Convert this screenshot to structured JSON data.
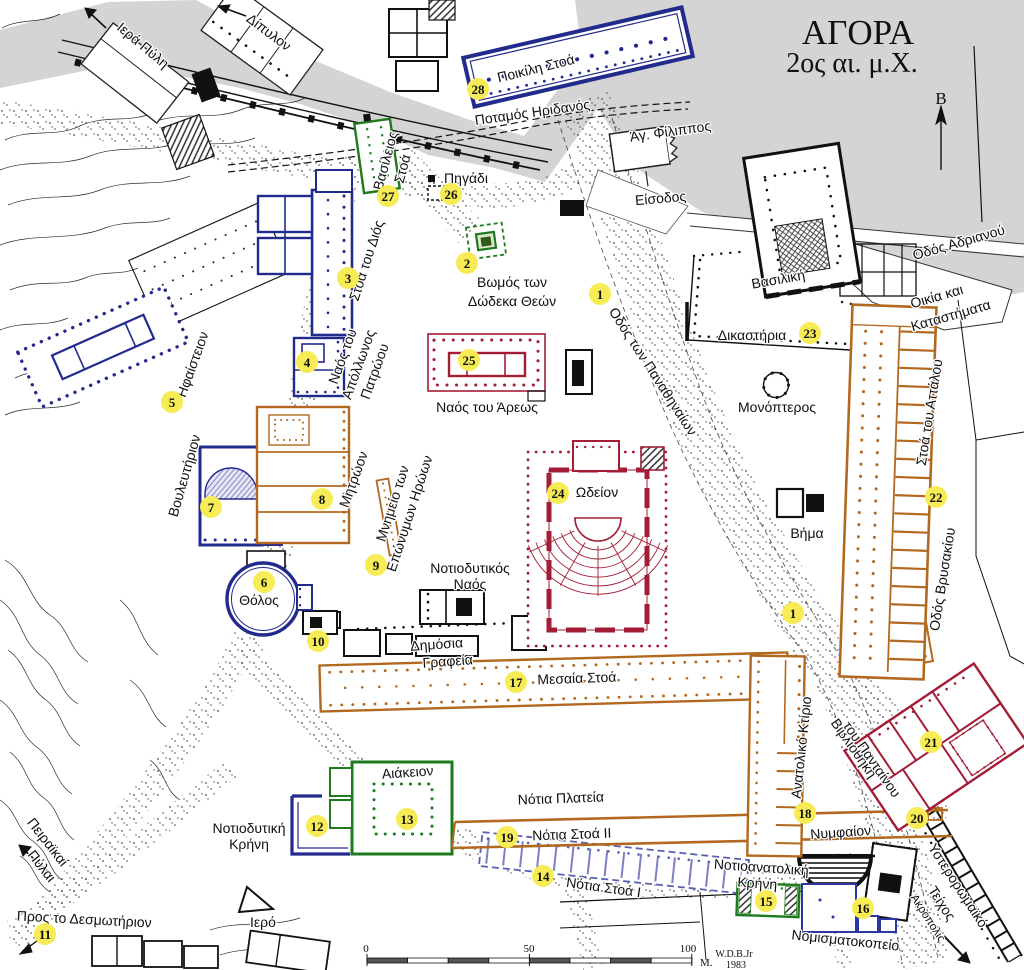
{
  "title": {
    "line1": "ΑΓΟΡΑ",
    "line2": "2ος αι. μ.Χ."
  },
  "compass": {
    "label": "B"
  },
  "scale": {
    "start": "0",
    "mid": "50",
    "end": "100",
    "unit": "M.",
    "credit1": "W.D.B.Jr",
    "credit2": "1983"
  },
  "colors": {
    "blue": "#222a8d",
    "green": "#1f7a1f",
    "orange": "#b2691f",
    "red": "#a31d36",
    "marker_yellow": "#f7ec55",
    "gray": "#d4d4d4"
  },
  "labels": {
    "iera_pyli": "Ιερά Πύλη",
    "dipylon": "Δίπυλον",
    "poikile_stoa": "Ποικίλη Στοά",
    "potamos_eridanos": "Ποταμός Ηριδανός",
    "ag_filippos": "Άγ. Φίλιππος",
    "eisodos": "Είσοδος",
    "odos_adrianou": "Οδός Αδριανού",
    "vasiliki": "Βασιλική",
    "oikia_1": "Οικία και",
    "oikia_2": "Καταστήματα",
    "dikastiria": "Δικαστήρια",
    "vasileios_1": "Βασίλειος",
    "vasileios_2": "Στοά",
    "pigadi": "Πηγάδι",
    "vomos_1": "Βωμός των",
    "vomos_2": "Δώδεκα Θεών",
    "odos_panathinaion": "Οδός των Παναθηναίων",
    "stoa_dios": "Στοά του Διός",
    "apollonos_1": "Ναός του",
    "apollonos_2": "Απόλλωνος",
    "apollonos_3": "Πατρώου",
    "hephaisteion": "Ηφαίστειον",
    "vouleuterion": "Βουλευτήριον",
    "mitroon": "Μητρώον",
    "mnimeio_1": "Μνημείο των",
    "mnimeio_2": "Επώνυμων Ηρώων",
    "tholos": "Θόλος",
    "naos_areos": "Ναός του Άρεως",
    "odeion": "Ωδείον",
    "monopteros": "Μονόπτερος",
    "vima": "Βήμα",
    "stoa_attalou": "Στοά του Αττάλου",
    "odos_vrysakiou": "Οδός Βρυσακίου",
    "notiodytikos_1": "Νοτιοδυτικός",
    "notiodytikos_2": "Ναός",
    "dimosia_1": "Δημόσια",
    "dimosia_2": "Γραφεία",
    "mesaia_stoa": "Μεσαία Στοά",
    "aiakeion": "Αιάκειον",
    "notia_plateia": "Νότια Πλατεία",
    "notia_stoa2": "Νότια Στοά II",
    "notia_stoa1": "Νότια Στοά I",
    "notiodytiki_1": "Νοτιοδυτική",
    "notiodytiki_2": "Κρήνη",
    "peiraikai_1": "Πειραϊκαί",
    "peiraikai_2": "Πύλαι",
    "pros_desmotirion": "Προς το Δεσμωτήριον",
    "iero": "Ιερό",
    "anatoliko_ktirio": "Ανατολικό Κτίριο",
    "vivliothiki_1": "Βιβλιοθήκη",
    "vivliothiki_2": "του Πανταίνου",
    "nymfaion": "Νυμφαίον",
    "notioanatoliki_1": "Νοτιοανατολική",
    "notioanatoliki_2": "Κρήνη",
    "nomismatokopeio": "Νομισματοκοπείο",
    "ysterorromaiko_1": "Υστερορωμαϊκό",
    "ysterorromaiko_2": "Τείχος",
    "akropolis": "Ακρόπολις"
  },
  "markers": {
    "n1a": "1",
    "n1b": "1",
    "n2": "2",
    "n3": "3",
    "n4": "4",
    "n5": "5",
    "n6": "6",
    "n7": "7",
    "n8": "8",
    "n9": "9",
    "n10": "10",
    "n11": "11",
    "n12": "12",
    "n13": "13",
    "n14": "14",
    "n15": "15",
    "n16": "16",
    "n17": "17",
    "n18": "18",
    "n19": "19",
    "n20": "20",
    "n21": "21",
    "n22": "22",
    "n23": "23",
    "n24": "24",
    "n25": "25",
    "n26": "26",
    "n27": "27",
    "n28": "28"
  }
}
